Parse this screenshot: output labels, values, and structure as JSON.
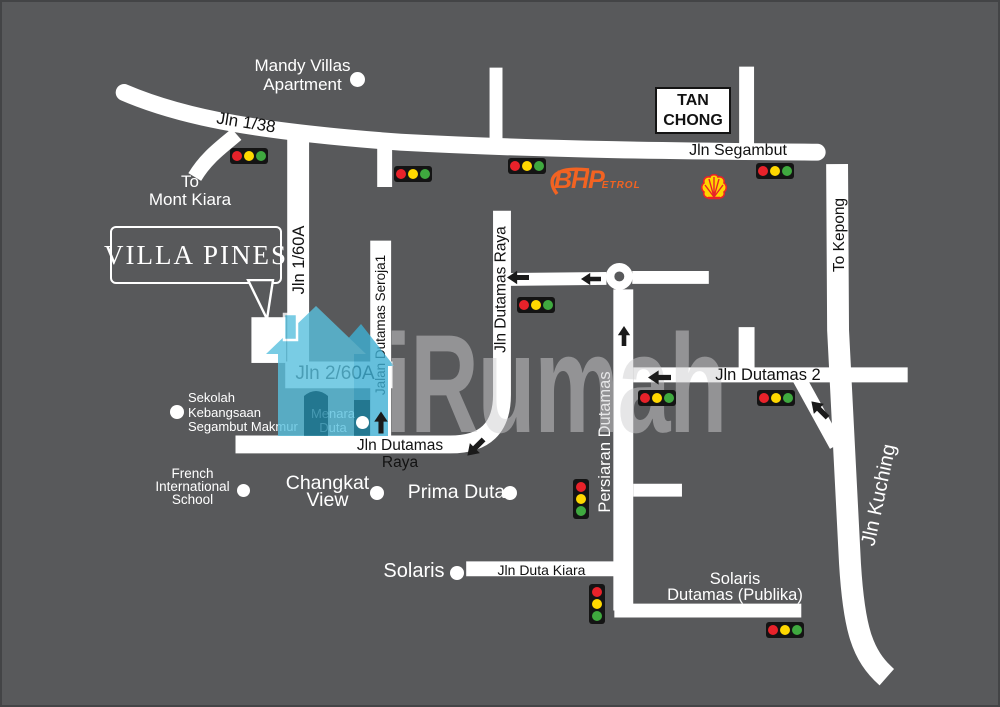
{
  "colors": {
    "background": "#58595b",
    "road": "#ffffff",
    "label_black": "#121212",
    "bhp_orange": "#f26322",
    "shell_yellow": "#ffd500",
    "shell_red": "#e8222a",
    "light_red": "#e8222a",
    "light_yellow": "#ffd800",
    "light_green": "#3fa93f",
    "watermark_blue": "#58c0de",
    "watermark_teal": "#1b93b4"
  },
  "branding": {
    "logo_part1": "VILLA",
    "logo_part2": "PINES",
    "watermark_text": "iRumah"
  },
  "businesses": {
    "tan_chong": "TAN\nCHONG",
    "bhp_main": "BHP",
    "bhp_sub": "ETROL"
  },
  "directions": {
    "to_mont_kiara": "To\nMont Kiara",
    "to_kepong": "To Kepong"
  },
  "roads": {
    "jln_1_38": "Jln 1/38",
    "jln_segambut": "Jln Segambut",
    "jln_1_60a": "Jln 1/60A",
    "jln_2_60a": "Jln 2/60A",
    "jalan_dutamas_seroja": "Jalan Dutamas Seroja1",
    "jln_dutamas_raya_vertical": "Jln Dutamas Raya",
    "jln_dutamas_raya_horizontal": "Jln Dutamas Raya",
    "persiaran_dutamas": "Persiaran Dutamas",
    "jln_dutamas_2": "Jln Dutamas 2",
    "jln_kuching": "Jln Kuching",
    "jln_duta_kiara": "Jln Duta Kiara"
  },
  "landmarks": {
    "mandy_villas": "Mandy Villas\nApartment",
    "sekolah": "Sekolah\nKebangsaan\nSegambut Makmur",
    "menara_duta": "Menara\nDuta",
    "french_school": "French\nInternational\nSchool",
    "changkat_view": "Changkat\nView",
    "prima_duta": "Prima Duta",
    "solaris": "Solaris",
    "solaris_dutamas": "Solaris\nDutamas (Publika)"
  }
}
